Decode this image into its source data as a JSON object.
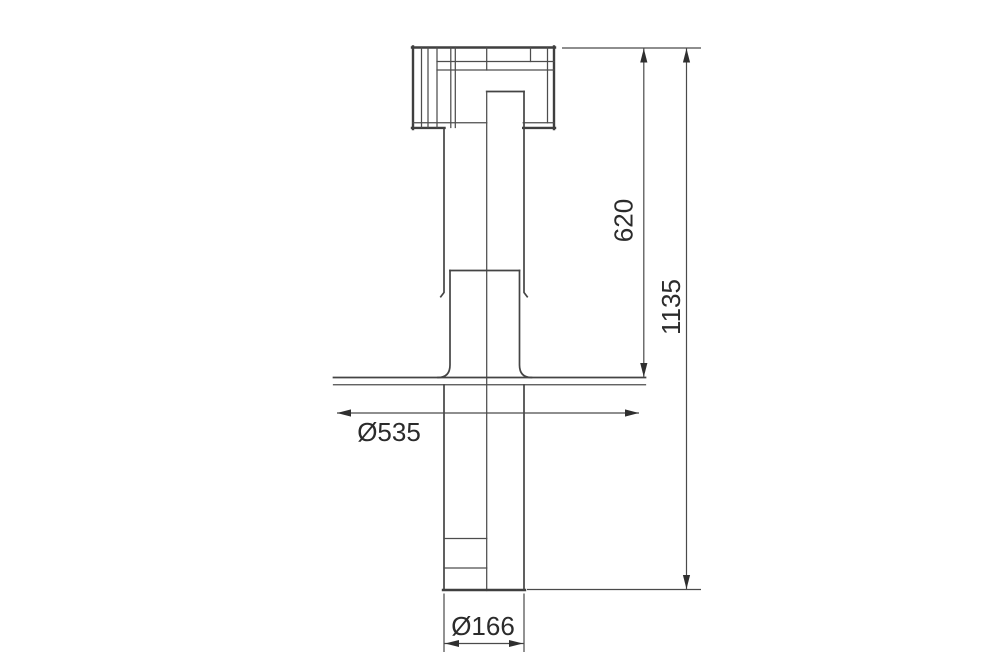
{
  "drawing": {
    "kind": "technical-dimension-drawing",
    "labels": {
      "upper_height": "620",
      "total_height": "1135",
      "flange_diameter": "Ø535",
      "spigot_diameter": "Ø166"
    },
    "colors": {
      "line": "#3f3f3f",
      "thin_line": "#4d4d4d",
      "text": "#2b2b2b",
      "background": "#ffffff"
    }
  }
}
